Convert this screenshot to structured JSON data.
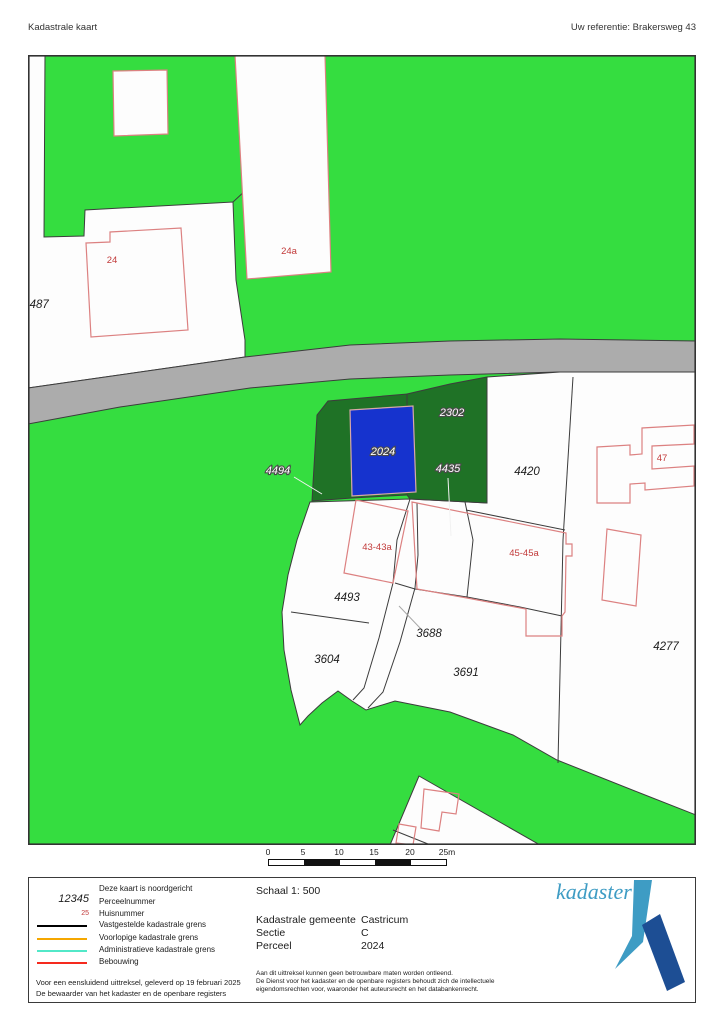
{
  "header": {
    "title": "Kadastrale kaart",
    "reference": "Uw referentie: Brakersweg 43"
  },
  "map": {
    "colors": {
      "terrain_green": "#35DD40",
      "parcel_dark_green": "#1F7226",
      "selected_parcel_blue": "#1633CE",
      "road_gray": "#ACACAC",
      "parcel_white": "#FDFDFD",
      "boundary_black": "#3C3C3C",
      "building_red": "#DC8181",
      "house_number_red": "#C23B3B"
    },
    "labels": {
      "p4487": "4487",
      "p4420": "4420",
      "p4493": "4493",
      "p3688": "3688",
      "p3604": "3604",
      "p3691": "3691",
      "p4277": "4277",
      "h24": "24",
      "h24a": "24a",
      "h47": "47",
      "h43": "43-43a",
      "h45": "45-45a",
      "p4494": "4494",
      "p2024": "2024",
      "p2302": "2302",
      "p4435": "4435"
    }
  },
  "scalebar": {
    "ticks": [
      "0",
      "5",
      "10",
      "15",
      "20",
      "25m"
    ]
  },
  "legend": {
    "north_note": "Deze kaart is noordgericht",
    "parcel_sample": "12345",
    "parcel_label": "Perceelnummer",
    "house_sample": "25",
    "house_label": "Huisnummer",
    "items": [
      {
        "label": "Vastgestelde kadastrale grens",
        "color": "#000000"
      },
      {
        "label": "Voorlopige kadastrale grens",
        "color": "#F5A700"
      },
      {
        "label": "Administratieve kadastrale grens",
        "color": "#52E8C8"
      },
      {
        "label": "Bebouwing",
        "color": "#F52A1E"
      }
    ],
    "footnote1": "Voor een eensluidend uittreksel, geleverd op 19 februari 2025",
    "footnote2": "De bewaarder van het kadaster en de openbare registers"
  },
  "details": {
    "scale": "Schaal 1: 500",
    "rows": [
      {
        "label": "Kadastrale gemeente",
        "value": "Castricum"
      },
      {
        "label": "Sectie",
        "value": "C"
      },
      {
        "label": "Perceel",
        "value": "2024"
      }
    ],
    "disclaimer1": "Aan dit uittreksel kunnen geen betrouwbare maten worden ontleend.",
    "disclaimer2": "De Dienst voor het kadaster en de openbare registers behoudt zich de intellectuele",
    "disclaimer3": "eigendomsrechten voor, waaronder het auteursrecht en het databankenrecht."
  },
  "logo": {
    "wordmark": "kadaster",
    "light_blue": "#3E9CC4",
    "dark_blue": "#1D4E94"
  }
}
